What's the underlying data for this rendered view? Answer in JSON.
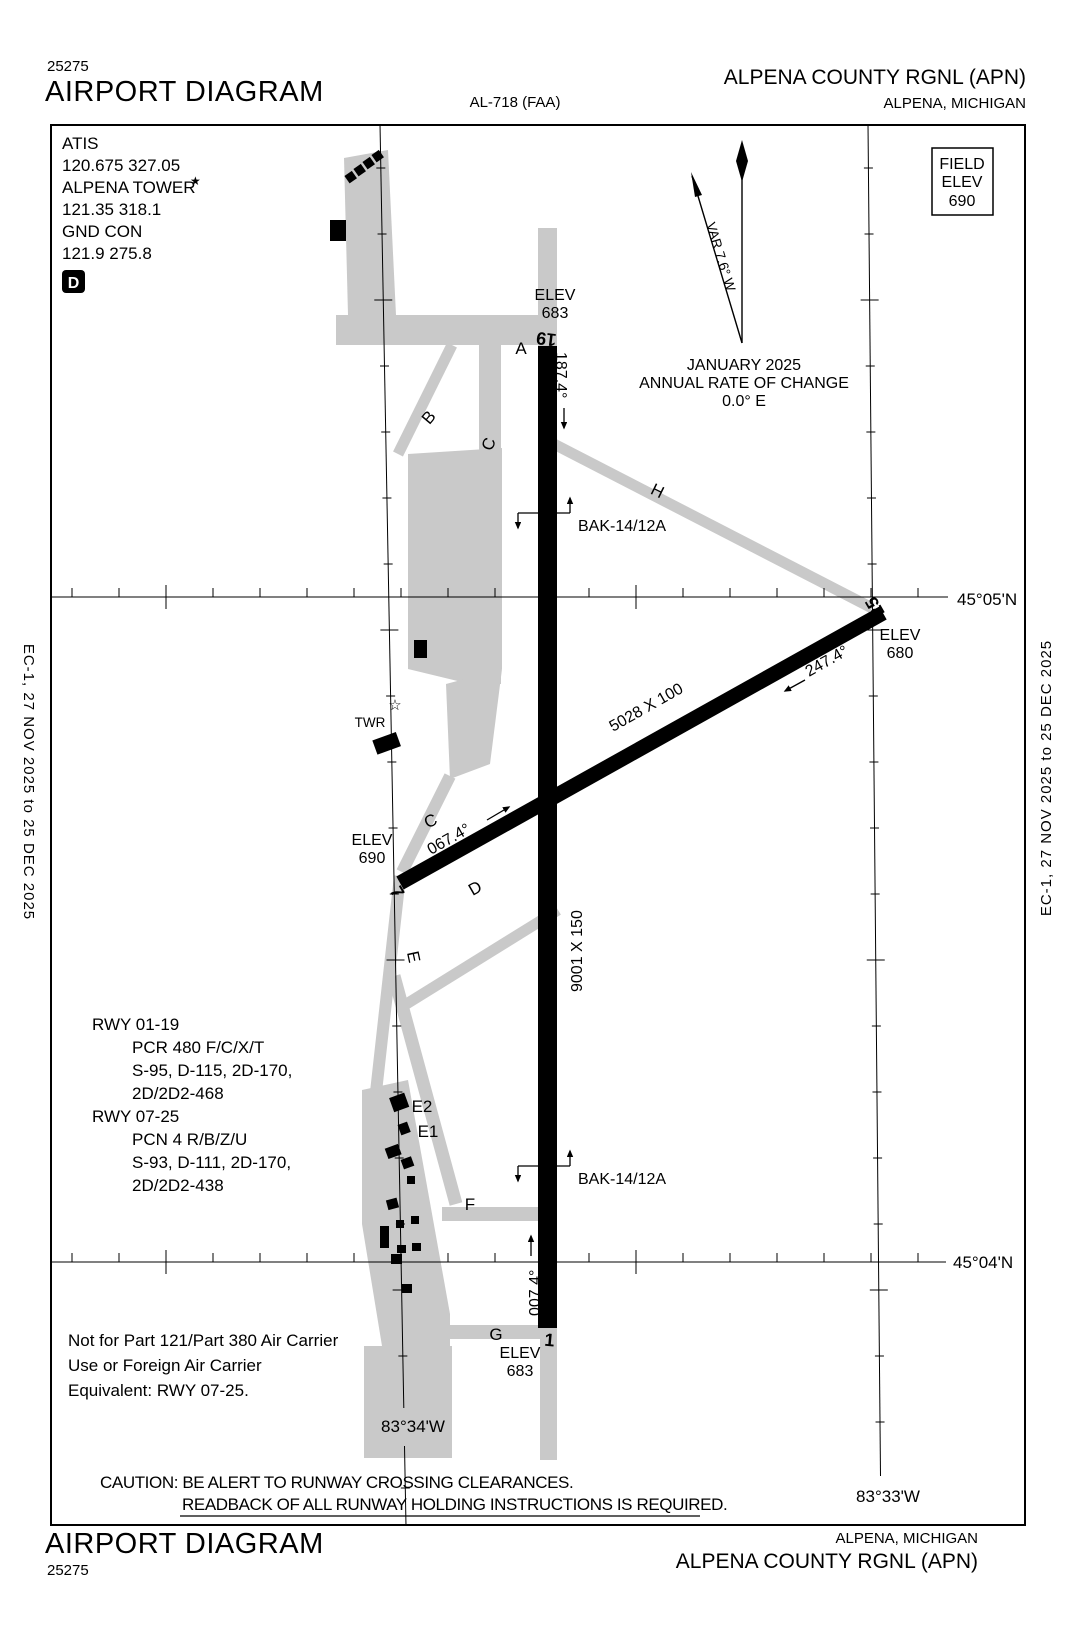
{
  "header": {
    "chart_code": "25275",
    "title": "AIRPORT DIAGRAM",
    "al_ref": "AL-718 (FAA)",
    "airport": "ALPENA COUNTY RGNL (APN)",
    "location": "ALPENA, MICHIGAN"
  },
  "footer": {
    "title": "AIRPORT DIAGRAM",
    "chart_code": "25275",
    "airport": "ALPENA COUNTY RGNL (APN)",
    "location": "ALPENA, MICHIGAN"
  },
  "edge_note": "EC-1, 27 NOV 2025 to 25 DEC 2025",
  "comms": {
    "atis_label": "ATIS",
    "atis_freqs": "120.675  327.05",
    "tower_label": "ALPENA TOWER",
    "tower_star": "★",
    "tower_freqs": "121.35  318.1",
    "gnd_label": "GND CON",
    "gnd_freqs": "121.9  275.8",
    "hotspot": "D"
  },
  "field_elev": {
    "l1": "FIELD",
    "l2": "ELEV",
    "l3": "690"
  },
  "compass": {
    "var": "VAR 7.6° W",
    "date": "JANUARY 2025",
    "rate_l1": "ANNUAL RATE OF CHANGE",
    "rate_l2": "0.0° E"
  },
  "graticule": {
    "lat_n": "45°05'N",
    "lat_s": "45°04'N",
    "lon_w": "83°34'W",
    "lon_e": "83°33'W"
  },
  "runway_0119": {
    "num_n": "19",
    "num_s": "1",
    "hdg_south": "187.4°",
    "hdg_north": "007.4°",
    "dims": "9001 X 150",
    "elev_n_label": "ELEV",
    "elev_n": "683",
    "elev_s_label": "ELEV",
    "elev_s": "683",
    "gear_n": "BAK-14/12A",
    "gear_s": "BAK-14/12A"
  },
  "runway_0725": {
    "num_w": "7",
    "num_e": "25",
    "hdg_east": "067.4°",
    "hdg_west": "247.4°",
    "dims": "5028 X 100",
    "elev_w_label": "ELEV",
    "elev_w": "690",
    "elev_e_label": "ELEV",
    "elev_e": "680"
  },
  "tower": {
    "symbol": "☆",
    "label": "TWR"
  },
  "taxiways": {
    "a": "A",
    "b": "B",
    "c_top": "C",
    "c_mid": "C",
    "d": "D",
    "e": "E",
    "e1": "E1",
    "e2": "E2",
    "f": "F",
    "g": "G",
    "h": "H"
  },
  "notes": {
    "rwy0119_title": "RWY 01-19",
    "rwy0119_l1": "PCR 480 F/C/X/T",
    "rwy0119_l2": "S-95, D-115, 2D-170,",
    "rwy0119_l3": "2D/2D2-468",
    "rwy0725_title": "RWY 07-25",
    "rwy0725_l1": "PCN 4 R/B/Z/U",
    "rwy0725_l2": "S-93, D-111, 2D-170,",
    "rwy0725_l3": "2D/2D2-438",
    "restriction_l1": "Not for Part 121/Part 380 Air Carrier",
    "restriction_l2": "Use or Foreign Air Carrier",
    "restriction_l3": "Equivalent: RWY 07-25.",
    "caution_l1": "CAUTION: BE ALERT TO RUNWAY CROSSING CLEARANCES.",
    "caution_l2": "READBACK OF ALL RUNWAY HOLDING INSTRUCTIONS IS REQUIRED."
  },
  "colors": {
    "pavement": "#c9c9c9",
    "runway": "#000000",
    "ink": "#000000"
  }
}
